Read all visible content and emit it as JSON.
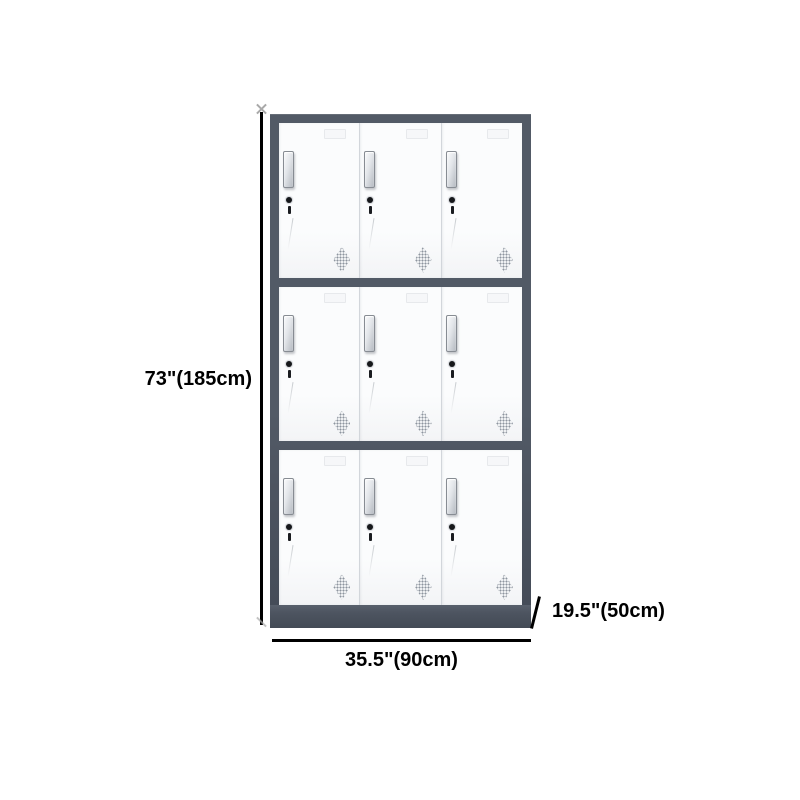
{
  "product": {
    "name": "metal-locker-cabinet",
    "rows": 3,
    "columns": 3,
    "door_count": 9
  },
  "dimensions": {
    "height_label": "73\"(185cm)",
    "width_label": "35.5\"(90cm)",
    "depth_label": "19.5\"(50cm)"
  },
  "colors": {
    "frame": "#525a66",
    "frame_dark": "#454c58",
    "base": "#4d5460",
    "door_face": "#fbfcfd",
    "door_separator": "#d2d6db",
    "handle_border": "#878c93",
    "vent_dots": "#8d959f",
    "dimension_line": "#000000",
    "label_text": "#000000"
  }
}
